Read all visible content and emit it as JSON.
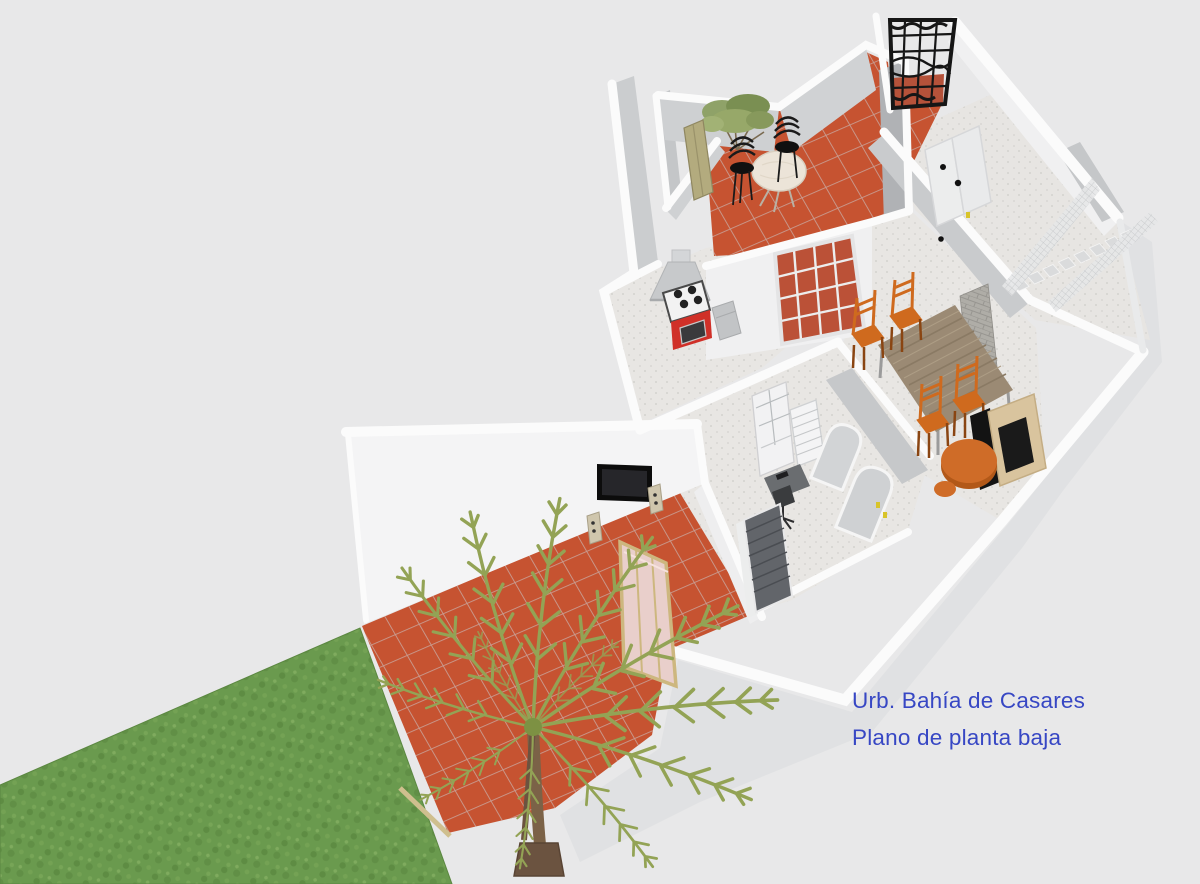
{
  "caption": {
    "line1": "Urb. Bahía de Casares",
    "line2": "Plano de planta baja",
    "color": "#3747c4"
  },
  "palette": {
    "background": "#e8e8e9",
    "wall_top_white": "#fbfbfb",
    "wall_face_light": "#d2d4d6",
    "wall_face_dark": "#b0b2b5",
    "terrace_tile": "#c65331",
    "tile_grout": "#bb8a7d",
    "lawn_green": "#6a9a4e",
    "palm_frond_green": "#93a355",
    "palm_trunk_brown": "#7b6247",
    "interior_floor": "#e8e6e3",
    "furniture_orange": "#cf6a1e",
    "table_wood": "#9b8a74",
    "stove_red": "#d03028",
    "iron_gate_black": "#161616",
    "screen_pink": "#e9cfcb",
    "frame_tan": "#cdb77f"
  },
  "scene": {
    "view": "3D ground-floor plan, aerial cutaway",
    "rooms": [
      "upper-terrace",
      "kitchen",
      "hallway",
      "dining-living-room",
      "study",
      "stair-hall",
      "lower-terrace",
      "garden"
    ],
    "objects": [
      "lawn",
      "palm-tree",
      "privacy-screen",
      "tv-screen",
      "speakers",
      "patio-table",
      "patio-chairs",
      "potted-plant",
      "wrought-iron-gate",
      "leaning-door-panel",
      "range-hood",
      "gas-stove",
      "french-glass-doors",
      "interior-doors",
      "staircase",
      "stair-railing",
      "brick-column",
      "dining-table",
      "dining-chairs",
      "fireplace",
      "coffee-table",
      "stool",
      "bookcase-hutch",
      "chest-of-drawers",
      "desk",
      "office-chair",
      "arched-double-doors",
      "louvered-door"
    ],
    "counts": {
      "dining_chairs": 4,
      "patio_chairs": 2
    }
  }
}
